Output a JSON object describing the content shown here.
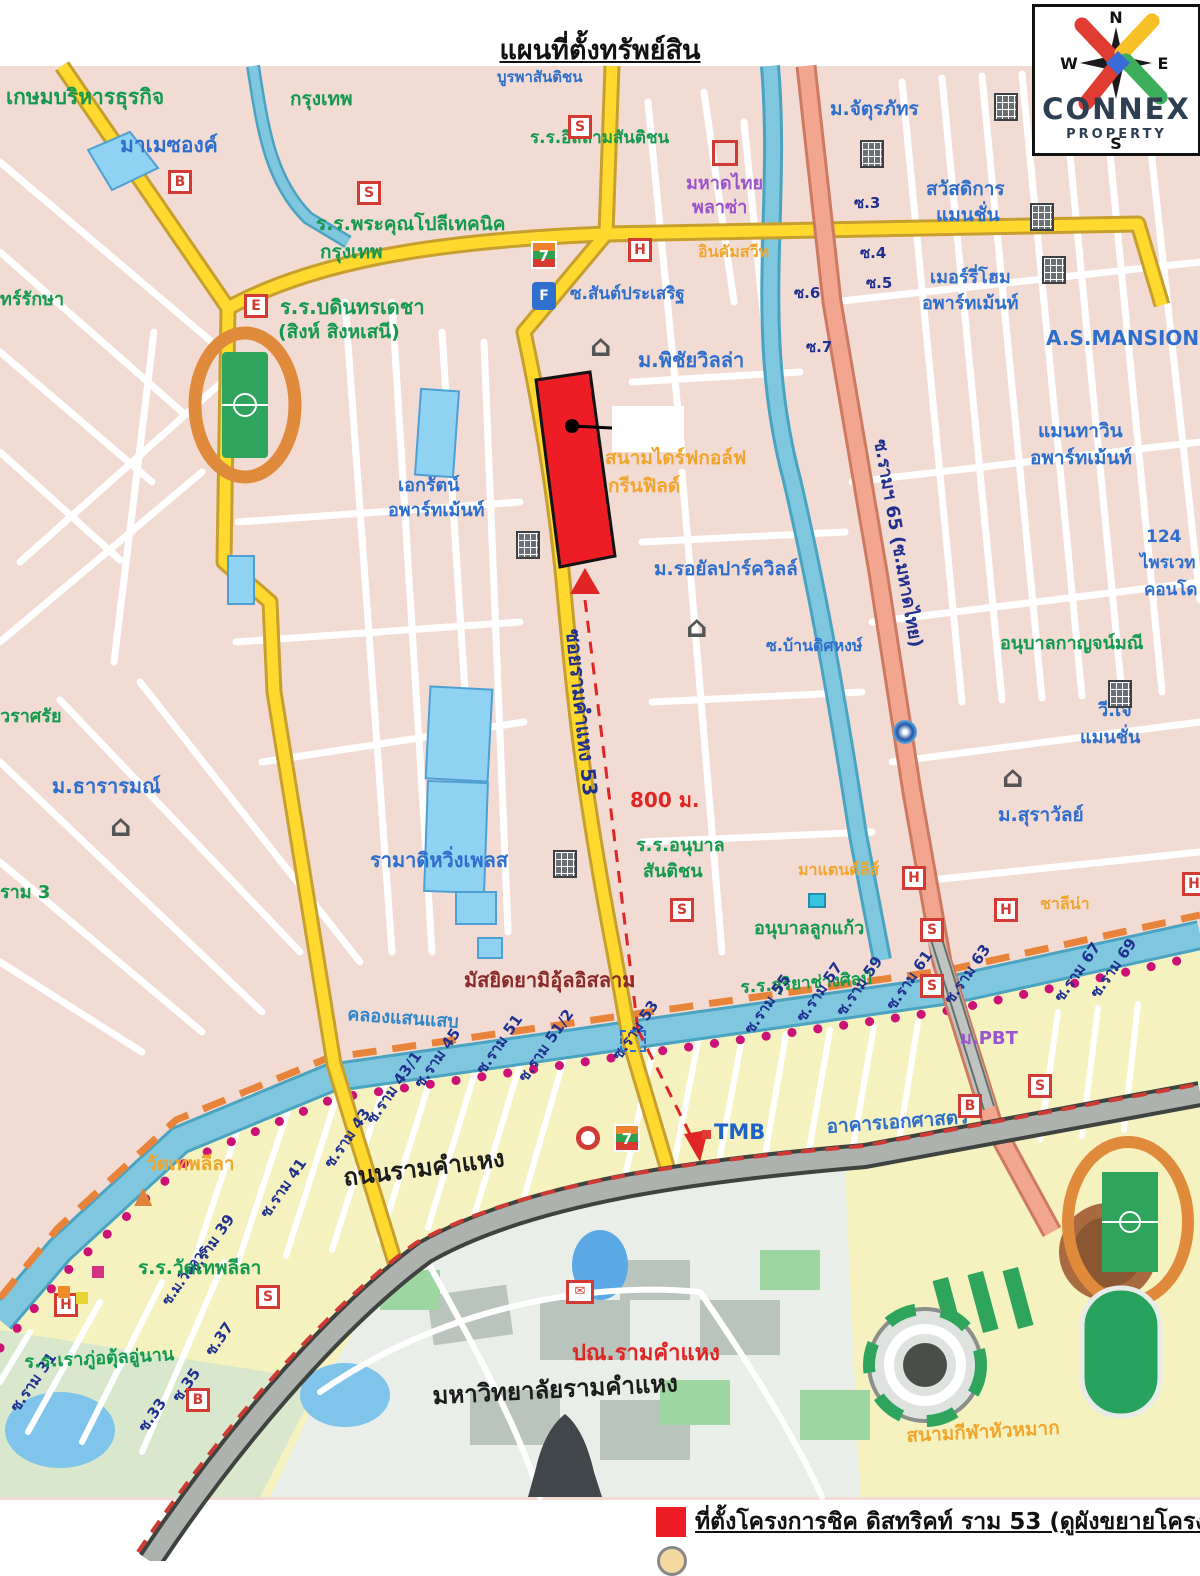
{
  "title": "แผนที่ตั้งทรัพย์สิน",
  "logo": {
    "name": "CONNEX",
    "subtitle": "PROPERTY",
    "compass": {
      "n": "N",
      "s": "S",
      "e": "E",
      "w": "W"
    }
  },
  "legend": {
    "marker_color": "#ee1c25",
    "text": "ที่ตั้งโครงการชิค ดิสทริคท์ ราม 53 (ดูผังขยายโครงการ)"
  },
  "colors": {
    "accent_red": "#ee1c25",
    "road_yellow": "#ffd92e",
    "road_salmon": "#f2a68f",
    "canal_blue": "#7ec7de",
    "zone_pink": "#f2dbd3",
    "zone_yellow": "#f5f2c0"
  },
  "map": {
    "labels": [
      {
        "t": "เกษมบริหารธุรกิจ",
        "x": 6,
        "y": 86,
        "c": "g",
        "s": 21
      },
      {
        "t": "กรุงเทพ",
        "x": 290,
        "y": 90,
        "c": "g",
        "s": 19
      },
      {
        "t": "มาเมซองค์",
        "x": 120,
        "y": 134,
        "c": "b",
        "s": 21
      },
      {
        "t": "บูรพาสันติชน",
        "x": 497,
        "y": 70,
        "c": "b",
        "s": 15
      },
      {
        "t": "ร.ร.อิสลามสันติชน",
        "x": 530,
        "y": 130,
        "c": "g",
        "s": 17
      },
      {
        "t": "มหาดไทย",
        "x": 686,
        "y": 175,
        "c": "p",
        "s": 18
      },
      {
        "t": "พลาซ่า",
        "x": 692,
        "y": 199,
        "c": "p",
        "s": 18
      },
      {
        "t": "ร.ร.พระคุณโปลีเทคนิค",
        "x": 316,
        "y": 215,
        "c": "g",
        "s": 19
      },
      {
        "t": "กรุงเทพ",
        "x": 320,
        "y": 243,
        "c": "g",
        "s": 19
      },
      {
        "t": "อินคัมสวีท",
        "x": 698,
        "y": 244,
        "c": "o",
        "s": 16
      },
      {
        "t": "ซ.สันต์ประเสริฐ",
        "x": 570,
        "y": 286,
        "c": "b",
        "s": 17
      },
      {
        "t": "ม.จัตุรภัทร",
        "x": 830,
        "y": 100,
        "c": "b",
        "s": 19
      },
      {
        "t": "สวัสดิการ",
        "x": 926,
        "y": 180,
        "c": "b",
        "s": 19
      },
      {
        "t": "แมนชั่น",
        "x": 936,
        "y": 206,
        "c": "b",
        "s": 19
      },
      {
        "t": "เมอร์รี่โฮม",
        "x": 930,
        "y": 269,
        "c": "b",
        "s": 18
      },
      {
        "t": "อพาร์ทเม้นท์",
        "x": 922,
        "y": 295,
        "c": "b",
        "s": 18
      },
      {
        "t": "A.S.MANSION",
        "x": 1046,
        "y": 328,
        "c": "b",
        "s": 20
      },
      {
        "t": "ซ.3",
        "x": 854,
        "y": 196,
        "c": "n",
        "s": 15
      },
      {
        "t": "ซ.4",
        "x": 860,
        "y": 246,
        "c": "n",
        "s": 15
      },
      {
        "t": "ซ.5",
        "x": 866,
        "y": 276,
        "c": "n",
        "s": 15
      },
      {
        "t": "ซ.6",
        "x": 794,
        "y": 286,
        "c": "n",
        "s": 15
      },
      {
        "t": "ซ.7",
        "x": 806,
        "y": 340,
        "c": "n",
        "s": 15
      },
      {
        "t": "ร.ร.บดินทรเดชา",
        "x": 280,
        "y": 297,
        "c": "g",
        "s": 20
      },
      {
        "t": "(สิงห์ สิงหเสนี)",
        "x": 278,
        "y": 323,
        "c": "g",
        "s": 19
      },
      {
        "t": "ทร์รักษา",
        "x": 0,
        "y": 291,
        "c": "g",
        "s": 18
      },
      {
        "t": "ม.พิชัยวิลล่า",
        "x": 638,
        "y": 350,
        "c": "b",
        "s": 20
      },
      {
        "t": "สนามไดร์ฟกอล์ฟ",
        "x": 605,
        "y": 449,
        "c": "o",
        "s": 19
      },
      {
        "t": "กรีนฟิลด์",
        "x": 608,
        "y": 477,
        "c": "o",
        "s": 19
      },
      {
        "t": "ม.รอยัลปาร์ควิลล์",
        "x": 654,
        "y": 560,
        "c": "b",
        "s": 19
      },
      {
        "t": "เอกรัตน์",
        "x": 398,
        "y": 477,
        "c": "b",
        "s": 18
      },
      {
        "t": "อพาร์ทเม้นท์",
        "x": 388,
        "y": 502,
        "c": "b",
        "s": 18
      },
      {
        "t": "แมนทาวิน",
        "x": 1038,
        "y": 422,
        "c": "b",
        "s": 19
      },
      {
        "t": "อพาร์ทเม้นท์",
        "x": 1030,
        "y": 449,
        "c": "b",
        "s": 19
      },
      {
        "t": "124",
        "x": 1146,
        "y": 529,
        "c": "b",
        "s": 17
      },
      {
        "t": "ไพรเวท",
        "x": 1140,
        "y": 555,
        "c": "b",
        "s": 17
      },
      {
        "t": "คอนโด",
        "x": 1144,
        "y": 582,
        "c": "b",
        "s": 17
      },
      {
        "t": "อนุบาลกาญจน์มณี",
        "x": 1000,
        "y": 635,
        "c": "g",
        "s": 18
      },
      {
        "t": "วี.เจ",
        "x": 1098,
        "y": 702,
        "c": "b",
        "s": 18
      },
      {
        "t": "แมนชั่น",
        "x": 1080,
        "y": 729,
        "c": "b",
        "s": 18
      },
      {
        "t": "ม.สุราวัลย์",
        "x": 998,
        "y": 806,
        "c": "b",
        "s": 19
      },
      {
        "t": "ซ.บ้านดิศหงษ์",
        "x": 766,
        "y": 638,
        "c": "b",
        "s": 16
      },
      {
        "t": "วราศรัย",
        "x": 0,
        "y": 708,
        "c": "g",
        "s": 18
      },
      {
        "t": "ม.ธารารมณ์",
        "x": 52,
        "y": 776,
        "c": "b",
        "s": 20
      },
      {
        "t": "ราม 3",
        "x": 0,
        "y": 884,
        "c": "g",
        "s": 18
      },
      {
        "t": "รามาดิหวิ่งเพลส",
        "x": 370,
        "y": 850,
        "c": "b",
        "s": 20
      },
      {
        "t": "ร.ร.อนุบาล",
        "x": 636,
        "y": 837,
        "c": "g",
        "s": 18
      },
      {
        "t": "สันติชน",
        "x": 643,
        "y": 863,
        "c": "g",
        "s": 18
      },
      {
        "t": "อนุบาลลูกแก้ว",
        "x": 754,
        "y": 920,
        "c": "g",
        "s": 18
      },
      {
        "t": "มาแตนด์ลีส์",
        "x": 798,
        "y": 862,
        "c": "o",
        "s": 16
      },
      {
        "t": "ชาลีน่า",
        "x": 1040,
        "y": 896,
        "c": "o",
        "s": 16
      },
      {
        "t": "ร.ร.สุริยาช่างศิลป์",
        "x": 740,
        "y": 980,
        "c": "g",
        "s": 17,
        "r": -4
      },
      {
        "t": "มัสยิดยามิอุ้ลอิสลาม",
        "x": 464,
        "y": 970,
        "c": "m",
        "s": 20
      },
      {
        "t": "คลองแสนแสบ",
        "x": 348,
        "y": 1006,
        "c": "cb",
        "s": 18,
        "r": 4
      },
      {
        "t": "800 ม.",
        "x": 630,
        "y": 790,
        "c": "r",
        "s": 20
      },
      {
        "t": "ซอยรามคำแหง 53",
        "x": 583,
        "y": 628,
        "c": "n",
        "s": 20,
        "r": 84
      },
      {
        "t": "ซ.รามฯ 65 (ซ.มหาดไทย)",
        "x": 888,
        "y": 438,
        "c": "n",
        "s": 18,
        "r": 80
      },
      {
        "t": "ถนนรามคำแหง",
        "x": 342,
        "y": 1166,
        "c": "d",
        "s": 24,
        "r": -7
      },
      {
        "t": "ซ.ราม 31",
        "x": 8,
        "y": 1406,
        "c": "n",
        "s": 15,
        "r": -55
      },
      {
        "t": "ซ.33",
        "x": 136,
        "y": 1426,
        "c": "n",
        "s": 15,
        "r": -55
      },
      {
        "t": "ซ.35",
        "x": 170,
        "y": 1396,
        "c": "n",
        "s": 15,
        "r": -55
      },
      {
        "t": "ซ.37",
        "x": 203,
        "y": 1350,
        "c": "n",
        "s": 15,
        "r": -55
      },
      {
        "t": "ซ.ม.วิถาวร",
        "x": 160,
        "y": 1300,
        "c": "n",
        "s": 14,
        "r": -55
      },
      {
        "t": "ซ.ราม 39",
        "x": 186,
        "y": 1268,
        "c": "n",
        "s": 15,
        "r": -55
      },
      {
        "t": "ซ.ราม 41",
        "x": 258,
        "y": 1212,
        "c": "n",
        "s": 15,
        "r": -55
      },
      {
        "t": "ซ.ราม 43",
        "x": 322,
        "y": 1162,
        "c": "n",
        "s": 15,
        "r": -55
      },
      {
        "t": "ซ.ราม 43/1",
        "x": 364,
        "y": 1118,
        "c": "n",
        "s": 15,
        "r": -55
      },
      {
        "t": "ซ.ราม 45",
        "x": 412,
        "y": 1082,
        "c": "n",
        "s": 15,
        "r": -55
      },
      {
        "t": "ซ.ราม 51",
        "x": 474,
        "y": 1068,
        "c": "n",
        "s": 15,
        "r": -55
      },
      {
        "t": "ซ.ราม 51/2",
        "x": 516,
        "y": 1076,
        "c": "n",
        "s": 15,
        "r": -55
      },
      {
        "t": "ซ.ราม 53",
        "x": 610,
        "y": 1054,
        "c": "n",
        "s": 15,
        "r": -55
      },
      {
        "t": "ซ.ราม 55",
        "x": 742,
        "y": 1028,
        "c": "n",
        "s": 15,
        "r": -55
      },
      {
        "t": "ซ.ราม 57",
        "x": 794,
        "y": 1016,
        "c": "n",
        "s": 15,
        "r": -55
      },
      {
        "t": "ซ.ราม 59",
        "x": 834,
        "y": 1010,
        "c": "n",
        "s": 15,
        "r": -55
      },
      {
        "t": "ซ.ราม 61",
        "x": 884,
        "y": 1004,
        "c": "n",
        "s": 15,
        "r": -55
      },
      {
        "t": "ซ.ราม 63",
        "x": 942,
        "y": 998,
        "c": "n",
        "s": 15,
        "r": -55
      },
      {
        "t": "ซ.ราม 67",
        "x": 1052,
        "y": 996,
        "c": "n",
        "s": 15,
        "r": -55
      },
      {
        "t": "ซ.ราม 69",
        "x": 1088,
        "y": 992,
        "c": "n",
        "s": 15,
        "r": -55
      },
      {
        "t": "ม.PBT",
        "x": 960,
        "y": 1030,
        "c": "p",
        "s": 18
      },
      {
        "t": "อาคารเอกศาสตร์",
        "x": 826,
        "y": 1118,
        "c": "b",
        "s": 19,
        "r": -4
      },
      {
        "t": "วัดเทพลีลา",
        "x": 146,
        "y": 1155,
        "c": "o",
        "s": 19
      },
      {
        "t": "ร.ร.วัดเทพลีลา",
        "x": 138,
        "y": 1259,
        "c": "g",
        "s": 19
      },
      {
        "t": "ร.ร.เราภู่อตุ้ลอู่นาน",
        "x": 24,
        "y": 1354,
        "c": "g",
        "s": 18,
        "r": -3
      },
      {
        "t": "ปณ.รามคำแหง",
        "x": 572,
        "y": 1342,
        "c": "r",
        "s": 22
      },
      {
        "t": "มหาวิทยาลัยรามคำแหง",
        "x": 432,
        "y": 1384,
        "c": "d",
        "s": 24,
        "r": -3
      },
      {
        "t": "สนามกีฬาหัวหมาก",
        "x": 906,
        "y": 1427,
        "c": "o",
        "s": 19,
        "r": -3
      }
    ],
    "icons": [
      {
        "type": "lb",
        "x": 568,
        "y": 115,
        "ch": "S"
      },
      {
        "type": "lb",
        "x": 357,
        "y": 181,
        "ch": "S"
      },
      {
        "type": "lb",
        "x": 168,
        "y": 170,
        "ch": "B"
      },
      {
        "type": "lb",
        "x": 244,
        "y": 294,
        "ch": "E"
      },
      {
        "type": "lb",
        "x": 628,
        "y": 238,
        "ch": "H"
      },
      {
        "type": "lb",
        "x": 1086,
        "y": 128,
        "ch": "H"
      },
      {
        "type": "rb",
        "x": 712,
        "y": 140
      },
      {
        "type": "lb",
        "x": 670,
        "y": 898,
        "ch": "S"
      },
      {
        "type": "lb",
        "x": 902,
        "y": 866,
        "ch": "H"
      },
      {
        "type": "lb",
        "x": 994,
        "y": 898,
        "ch": "H"
      },
      {
        "type": "lb",
        "x": 920,
        "y": 918,
        "ch": "S"
      },
      {
        "type": "lb",
        "x": 920,
        "y": 974,
        "ch": "S"
      },
      {
        "type": "lb",
        "x": 1182,
        "y": 872,
        "ch": "H"
      },
      {
        "type": "lb",
        "x": 54,
        "y": 1293,
        "ch": "H"
      },
      {
        "type": "lb",
        "x": 256,
        "y": 1285,
        "ch": "S"
      },
      {
        "type": "lb",
        "x": 186,
        "y": 1388,
        "ch": "B"
      },
      {
        "type": "lb",
        "x": 1028,
        "y": 1074,
        "ch": "S"
      },
      {
        "type": "lb",
        "x": 958,
        "y": 1094,
        "ch": "B"
      },
      {
        "type": "sev",
        "x": 531,
        "y": 241,
        "ch": "7"
      },
      {
        "type": "sev",
        "x": 614,
        "y": 1124,
        "ch": "7"
      },
      {
        "type": "fuel",
        "x": 532,
        "y": 282,
        "ch": "F"
      },
      {
        "type": "bld",
        "x": 860,
        "y": 140
      },
      {
        "type": "bld",
        "x": 994,
        "y": 93
      },
      {
        "type": "bld",
        "x": 1030,
        "y": 203
      },
      {
        "type": "bld",
        "x": 1042,
        "y": 256
      },
      {
        "type": "bld",
        "x": 516,
        "y": 531
      },
      {
        "type": "bld",
        "x": 553,
        "y": 850
      },
      {
        "type": "bld",
        "x": 1108,
        "y": 680
      },
      {
        "type": "hse",
        "x": 590,
        "y": 333,
        "ch": "⌂"
      },
      {
        "type": "hse",
        "x": 686,
        "y": 614,
        "ch": "⌂"
      },
      {
        "type": "hse",
        "x": 1002,
        "y": 764,
        "ch": "⌂"
      },
      {
        "type": "hse",
        "x": 110,
        "y": 813,
        "ch": "⌂"
      },
      {
        "type": "wat",
        "x": 134,
        "y": 1183,
        "ch": "▲"
      },
      {
        "type": "shr",
        "x": 576,
        "y": 1126
      },
      {
        "type": "csq",
        "x": 808,
        "y": 893
      },
      {
        "type": "swl",
        "x": 893,
        "y": 720
      },
      {
        "type": "post",
        "x": 566,
        "y": 1280,
        "ch": "✉"
      },
      {
        "type": "msq",
        "x": 620,
        "y": 1030
      },
      {
        "type": "poi",
        "x": 92,
        "y": 1266,
        "color": "#d4317f"
      },
      {
        "type": "poi",
        "x": 58,
        "y": 1286,
        "color": "#f08a2a"
      },
      {
        "type": "poi",
        "x": 76,
        "y": 1292,
        "color": "#e8d332"
      },
      {
        "type": "tmb",
        "x": 702,
        "y": 1120,
        "ch": "TMB"
      }
    ]
  }
}
